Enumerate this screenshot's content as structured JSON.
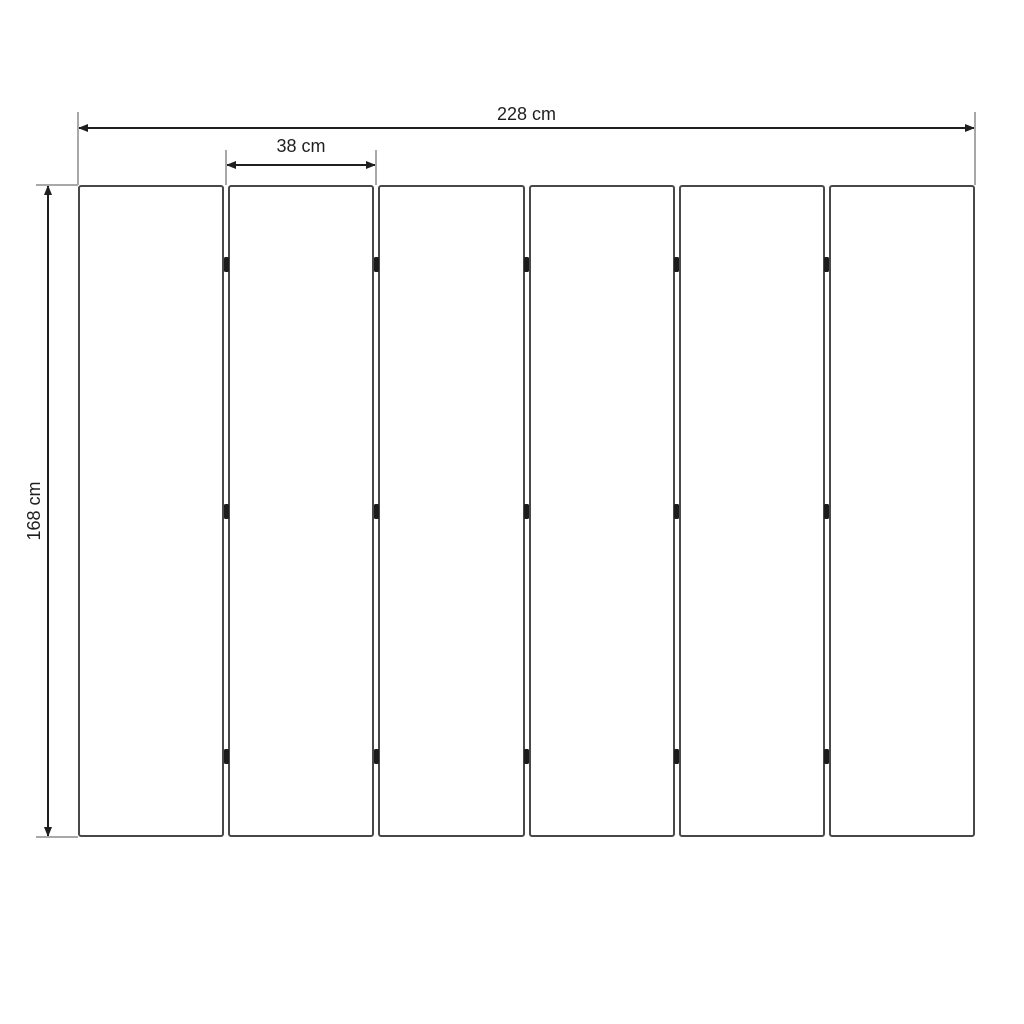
{
  "diagram": {
    "type": "technical-dimension-drawing",
    "subject": "six-panel folding divider, front elevation",
    "panel_count": 6,
    "junction_count": 5,
    "hinges_per_junction": 3,
    "dimensions": {
      "total_width": {
        "value": 228,
        "unit": "cm",
        "label": "228 cm"
      },
      "panel_width": {
        "value": 38,
        "unit": "cm",
        "label": "38 cm"
      },
      "height": {
        "value": 168,
        "unit": "cm",
        "label": "168 cm"
      }
    },
    "colors": {
      "background": "#ffffff",
      "panel_border": "#484848",
      "panel_fill": "#ffffff",
      "dimension": "#1f1f1f",
      "extension_line": "#a8a8a8",
      "hinge": "#1b1b1b"
    }
  }
}
